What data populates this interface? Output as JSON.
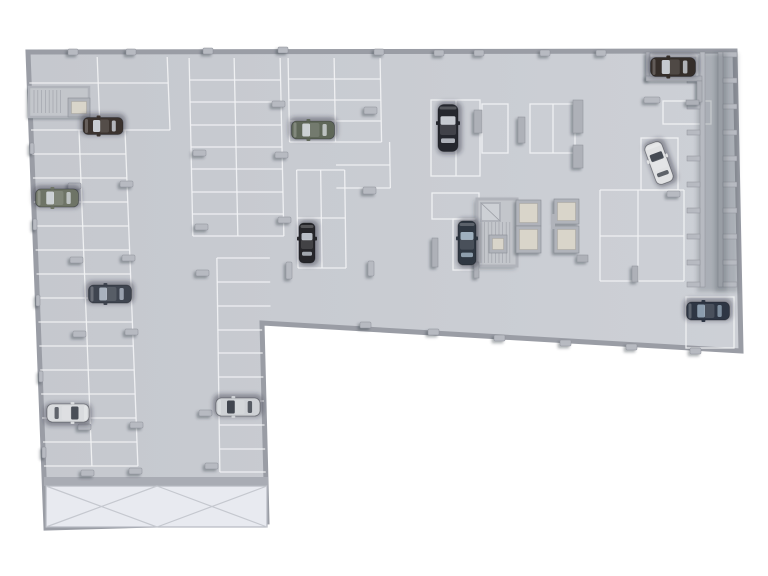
{
  "scene": {
    "description": "3d-top-down-render-of-underground-parking-garage-floor-plan",
    "canvas": {
      "w": 768,
      "h": 576,
      "bg": "#ffffff"
    },
    "colors": {
      "floor_light": "#cdd0d6",
      "floor_dark": "#c5c8ce",
      "line": "#f2f3f5",
      "wall_stroke": "#9a9da5",
      "pillar": "#b7bac1",
      "pillar_edge": "#8f929a",
      "shadow": "rgba(45,50,60,0.35)",
      "core_wall": "#b0b3ba",
      "core_floor": "#c3c6cb",
      "lift_inner": "#d9d5ca",
      "hatch": "#9fa2a9",
      "ramp": "#e8eaf0",
      "ramp_line": "#c5c8cf",
      "ramp_wall": "#a9acb4"
    },
    "outline": [
      [
        28,
        52
      ],
      [
        735,
        51
      ],
      [
        741,
        351
      ],
      [
        262,
        323
      ],
      [
        267,
        522
      ],
      [
        46,
        528
      ]
    ],
    "grids": [
      {
        "name": "stalls-top-left",
        "x0": 28,
        "x1": 167,
        "cols": [
          97,
          167
        ],
        "y0": 57,
        "y1": 130,
        "rows": [
          83,
          130
        ],
        "skew": 2.2
      },
      {
        "name": "stalls-west-wall",
        "x0": 28,
        "x1": 122,
        "cols": [
          76,
          122
        ],
        "y0": 130,
        "y1": 466,
        "rows": [
          154,
          178,
          202,
          226,
          250,
          274,
          298,
          322,
          346,
          370,
          394,
          418,
          442,
          466
        ],
        "skew": 2.2
      },
      {
        "name": "stalls-mid-left",
        "x0": 189,
        "x1": 280,
        "cols": [
          189,
          234,
          280
        ],
        "y0": 58,
        "y1": 236,
        "rows": [
          80,
          102,
          125,
          147,
          169,
          192,
          214,
          236
        ],
        "skew": 1.2
      },
      {
        "name": "stalls-east-lower-wing",
        "x0": 214,
        "x1": 267,
        "cols": [
          214
        ],
        "y0": 258,
        "y1": 472,
        "rows": [
          258,
          282,
          306,
          330,
          353,
          377,
          401,
          425,
          449,
          472
        ],
        "skew": 0.8
      },
      {
        "name": "stalls-center-block",
        "x0": 288,
        "x1": 380,
        "cols": [
          288,
          334,
          380
        ],
        "y0": 58,
        "y1": 142,
        "rows": [
          79,
          100,
          121,
          142
        ],
        "skew": 1.0
      },
      {
        "name": "stalls-center-block-east",
        "x0": 334,
        "x1": 388,
        "cols": [
          388
        ],
        "y0": 142,
        "y1": 188,
        "rows": [
          165,
          188
        ],
        "skew": 1.0
      },
      {
        "name": "stalls-center-vertical",
        "x0": 295,
        "x1": 343,
        "cols": [
          295,
          319,
          343
        ],
        "y0": 170,
        "y1": 268,
        "rows": [
          170,
          218,
          268
        ],
        "skew": 0.8
      },
      {
        "name": "stalls-right-block",
        "x0": 600,
        "x1": 684,
        "cols": [
          600,
          638,
          684
        ],
        "y0": 190,
        "y1": 281,
        "rows": [
          190,
          236,
          281
        ],
        "skew": 0
      }
    ],
    "stall_outlines": [
      {
        "r": [
          431,
          100,
          49,
          76
        ],
        "vmid": 456
      },
      {
        "r": [
          482,
          104,
          26,
          49
        ]
      },
      {
        "r": [
          530,
          104,
          45,
          49
        ],
        "vmid": 553
      },
      {
        "r": [
          432,
          193,
          47,
          26
        ]
      },
      {
        "r": [
          453,
          219,
          26,
          51
        ]
      },
      {
        "r": [
          686,
          297,
          48,
          51
        ]
      },
      {
        "r": [
          648,
          56,
          49,
          25
        ]
      },
      {
        "r": [
          641,
          138,
          37,
          52
        ]
      },
      {
        "r": [
          663,
          101,
          48,
          23
        ]
      }
    ],
    "ramp": {
      "wall": [
        44,
        477,
        224,
        9
      ],
      "area": [
        46,
        486,
        221,
        41
      ],
      "boxes": [
        [
          46,
          486,
          111,
          41
        ],
        [
          157,
          486,
          110,
          41
        ]
      ]
    },
    "stair_top_left": {
      "outer": [
        29,
        87,
        60,
        30
      ],
      "hatch": {
        "x0": 34,
        "x1": 63,
        "y0": 90,
        "y1": 113,
        "step": 3.8
      },
      "lift": [
        68,
        98,
        22,
        19
      ]
    },
    "core_main": {
      "outer": [
        477,
        199,
        40,
        67
      ],
      "diag_cell": [
        481,
        203,
        19,
        18
      ],
      "lift": [
        489,
        235,
        18,
        18
      ],
      "hatch": {
        "x0": 481,
        "x1": 513,
        "y0": 222,
        "y1": 263,
        "step": 3.6
      }
    },
    "lift_cells": [
      [
        516,
        200,
        25,
        26
      ],
      [
        516,
        226,
        25,
        27
      ],
      [
        554,
        199,
        25,
        25
      ],
      [
        554,
        226,
        25,
        27
      ]
    ],
    "core_stub": [
      551,
      214,
      4,
      15
    ],
    "ladders": [
      {
        "name": "right-wall-storage-outer",
        "rail": [
          718,
          52,
          5,
          235
        ],
        "rx": 723,
        "rw": 14,
        "rh": 5,
        "ys": [
          52,
          78,
          104,
          130,
          156,
          182,
          208,
          234,
          260,
          282
        ]
      },
      {
        "name": "right-wall-storage-inner",
        "rail": [
          700,
          52,
          5,
          235
        ],
        "rx": 687,
        "rw": 13,
        "rh": 5,
        "ys": [
          78,
          104,
          130,
          156,
          182,
          208,
          234,
          260,
          282
        ]
      }
    ],
    "walls": [
      [
        646,
        52,
        4,
        28
      ],
      [
        646,
        76,
        56,
        5
      ],
      [
        697,
        81,
        5,
        21
      ],
      [
        686,
        100,
        13,
        5
      ],
      [
        573,
        100,
        10,
        33
      ],
      [
        573,
        145,
        10,
        23
      ],
      [
        474,
        110,
        8,
        23
      ],
      [
        518,
        117,
        7,
        26
      ],
      [
        432,
        238,
        6,
        29
      ],
      [
        474,
        262,
        5,
        16
      ],
      [
        577,
        255,
        11,
        7
      ],
      [
        632,
        266,
        6,
        16
      ]
    ],
    "pillars": [
      {
        "x": 68,
        "y": 49,
        "w": 10,
        "h": 6
      },
      {
        "x": 126,
        "y": 49,
        "w": 10,
        "h": 6
      },
      {
        "x": 203,
        "y": 48,
        "w": 10,
        "h": 6
      },
      {
        "x": 278,
        "y": 47,
        "w": 10,
        "h": 6
      },
      {
        "x": 374,
        "y": 49,
        "w": 10,
        "h": 6
      },
      {
        "x": 434,
        "y": 50,
        "w": 10,
        "h": 6
      },
      {
        "x": 474,
        "y": 50,
        "w": 10,
        "h": 6
      },
      {
        "x": 540,
        "y": 50,
        "w": 10,
        "h": 6
      },
      {
        "x": 596,
        "y": 50,
        "w": 10,
        "h": 6
      },
      {
        "x": 30,
        "y": 143,
        "w": 4,
        "h": 11
      },
      {
        "x": 33,
        "y": 219,
        "w": 4,
        "h": 11
      },
      {
        "x": 36,
        "y": 295,
        "w": 4,
        "h": 11
      },
      {
        "x": 39,
        "y": 371,
        "w": 4,
        "h": 11
      },
      {
        "x": 42,
        "y": 447,
        "w": 4,
        "h": 11
      },
      {
        "x": 68,
        "y": 183,
        "w": 13,
        "h": 6
      },
      {
        "x": 120,
        "y": 181,
        "w": 13,
        "h": 6
      },
      {
        "x": 70,
        "y": 257,
        "w": 13,
        "h": 6
      },
      {
        "x": 122,
        "y": 255,
        "w": 13,
        "h": 6
      },
      {
        "x": 73,
        "y": 331,
        "w": 13,
        "h": 6
      },
      {
        "x": 125,
        "y": 329,
        "w": 13,
        "h": 6
      },
      {
        "x": 78,
        "y": 424,
        "w": 13,
        "h": 6
      },
      {
        "x": 130,
        "y": 422,
        "w": 13,
        "h": 6
      },
      {
        "x": 81,
        "y": 470,
        "w": 13,
        "h": 6
      },
      {
        "x": 129,
        "y": 468,
        "w": 13,
        "h": 6
      },
      {
        "x": 193,
        "y": 150,
        "w": 13,
        "h": 6
      },
      {
        "x": 195,
        "y": 224,
        "w": 13,
        "h": 6
      },
      {
        "x": 196,
        "y": 270,
        "w": 13,
        "h": 6
      },
      {
        "x": 199,
        "y": 410,
        "w": 13,
        "h": 6
      },
      {
        "x": 205,
        "y": 463,
        "w": 13,
        "h": 6
      },
      {
        "x": 272,
        "y": 101,
        "w": 13,
        "h": 6
      },
      {
        "x": 275,
        "y": 152,
        "w": 13,
        "h": 6
      },
      {
        "x": 278,
        "y": 217,
        "w": 13,
        "h": 6
      },
      {
        "x": 286,
        "y": 262,
        "w": 6,
        "h": 17
      },
      {
        "x": 364,
        "y": 107,
        "w": 13,
        "h": 7
      },
      {
        "x": 363,
        "y": 187,
        "w": 13,
        "h": 7
      },
      {
        "x": 368,
        "y": 261,
        "w": 6,
        "h": 15
      },
      {
        "x": 360,
        "y": 322,
        "w": 11,
        "h": 6
      },
      {
        "x": 428,
        "y": 329,
        "w": 11,
        "h": 6
      },
      {
        "x": 494,
        "y": 335,
        "w": 11,
        "h": 6
      },
      {
        "x": 560,
        "y": 340,
        "w": 11,
        "h": 6
      },
      {
        "x": 626,
        "y": 344,
        "w": 11,
        "h": 6
      },
      {
        "x": 690,
        "y": 348,
        "w": 11,
        "h": 6
      },
      {
        "x": 644,
        "y": 97,
        "w": 16,
        "h": 6
      },
      {
        "x": 667,
        "y": 191,
        "w": 13,
        "h": 6
      }
    ],
    "cars": [
      {
        "id": "car-dark-sedan-topleft",
        "x": 103,
        "y": 126,
        "r": 180,
        "l": 40,
        "w": 17,
        "body": "#3b332f",
        "glass": "#c9cdd3"
      },
      {
        "id": "car-olive-sedan-west",
        "x": 57,
        "y": 198,
        "r": 180,
        "l": 43,
        "w": 18,
        "body": "#6e7466",
        "glass": "#ccd1d4"
      },
      {
        "id": "car-slate-sedan-west",
        "x": 110,
        "y": 294,
        "r": 180,
        "l": 43,
        "w": 18,
        "body": "#3f4550",
        "glass": "#a9b2be"
      },
      {
        "id": "car-white-sedan-southwest",
        "x": 68,
        "y": 413,
        "r": 0,
        "l": 42,
        "w": 18,
        "body": "#d9dbde",
        "glass": "#4a4f58"
      },
      {
        "id": "car-silver-sedan-south",
        "x": 238,
        "y": 407,
        "r": 180,
        "l": 44,
        "w": 18,
        "body": "#ced1d5",
        "glass": "#41464f"
      },
      {
        "id": "car-green-sedan-center",
        "x": 313,
        "y": 130,
        "r": 180,
        "l": 43,
        "w": 18,
        "body": "#5f6759",
        "glass": "#ccd1d4"
      },
      {
        "id": "car-black-sedan-center",
        "x": 307,
        "y": 243,
        "r": 270,
        "l": 40,
        "w": 16,
        "body": "#26262a",
        "glass": "#b9bec6"
      },
      {
        "id": "car-dark-van-center",
        "x": 448,
        "y": 128,
        "r": 270,
        "l": 47,
        "w": 20,
        "body": "#25272e",
        "glass": "#c6cad1"
      },
      {
        "id": "car-blue-sedan-by-core",
        "x": 467,
        "y": 243,
        "r": 270,
        "l": 44,
        "w": 18,
        "body": "#2f3742",
        "glass": "#9fb0bf"
      },
      {
        "id": "car-brown-sedan-topright",
        "x": 673,
        "y": 67,
        "r": 180,
        "l": 45,
        "w": 19,
        "body": "#352e2a",
        "glass": "#c5c9cf"
      },
      {
        "id": "car-white-suv-diagonal",
        "x": 659,
        "y": 163,
        "r": 250,
        "l": 42,
        "w": 18,
        "body": "#e1e2e4",
        "glass": "#464b54"
      },
      {
        "id": "car-navy-sedan-southeast",
        "x": 708,
        "y": 311,
        "r": 180,
        "l": 43,
        "w": 18,
        "body": "#2e3644",
        "glass": "#8c9dae"
      }
    ]
  }
}
